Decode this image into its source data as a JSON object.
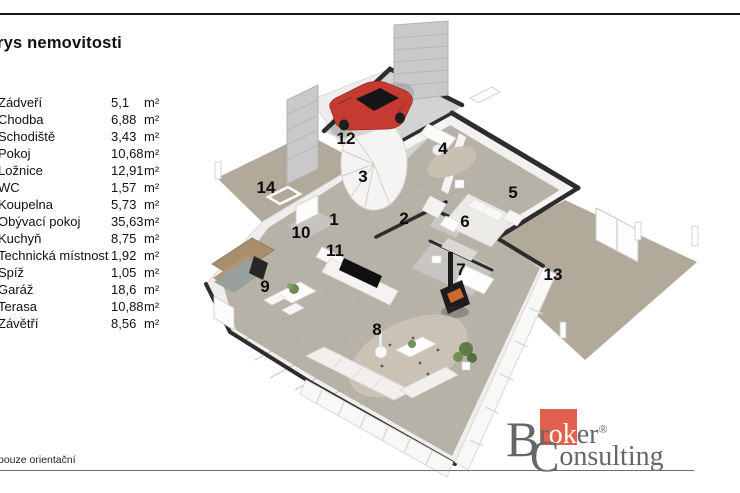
{
  "page": {
    "title": "rys nemovitosti",
    "footnote": "pouze orientační"
  },
  "legend": {
    "unit": "m²"
  },
  "rooms": [
    {
      "num": 1,
      "name": "Zádveří",
      "area": "5,1",
      "x": 334,
      "y": 219
    },
    {
      "num": 2,
      "name": "Chodba",
      "area": "6,88",
      "x": 404,
      "y": 218
    },
    {
      "num": 3,
      "name": "Schodiště",
      "area": "3,43",
      "x": 363,
      "y": 176
    },
    {
      "num": 4,
      "name": "Pokoj",
      "area": "10,68",
      "x": 443,
      "y": 148
    },
    {
      "num": 5,
      "name": "Ložnice",
      "area": "12,91",
      "x": 513,
      "y": 192
    },
    {
      "num": 6,
      "name": "WC",
      "area": "1,57",
      "x": 465,
      "y": 221
    },
    {
      "num": 7,
      "name": "Koupelna",
      "area": "5,73",
      "x": 461,
      "y": 269
    },
    {
      "num": 8,
      "name": "Obývací pokoj",
      "area": "35,63",
      "x": 377,
      "y": 329
    },
    {
      "num": 9,
      "name": "Kuchyň",
      "area": "8,75",
      "x": 265,
      "y": 286
    },
    {
      "num": 10,
      "name": "Technická místnost",
      "area": "1,92",
      "x": 301,
      "y": 232
    },
    {
      "num": 11,
      "name": "Spíž",
      "area": "1,05",
      "x": 335,
      "y": 250
    },
    {
      "num": 12,
      "name": "Garáž",
      "area": "18,6",
      "x": 346,
      "y": 138
    },
    {
      "num": 13,
      "name": "Terasa",
      "area": "10,88",
      "x": 553,
      "y": 274
    },
    {
      "num": 14,
      "name": "Závětří",
      "area": "8,56",
      "x": 266,
      "y": 187
    }
  ],
  "logo": {
    "b": "B",
    "r1": "r",
    "ok": "ok",
    "er": "er",
    "reg": "®",
    "c": "C",
    "onsulting": "onsulting",
    "accent": "#e2614e",
    "text_color": "#63676a"
  },
  "colors": {
    "floor_wood": "#b7b2a8",
    "terrace_concrete": "#b1aa9a",
    "garage_concrete": "#d3d3d1",
    "wall_cap_dark": "#2d2d2d",
    "wall_white": "#efeeec",
    "car_red": "#c53a31",
    "rule_dark": "#161616",
    "rule_gray": "#6e6e6e"
  }
}
